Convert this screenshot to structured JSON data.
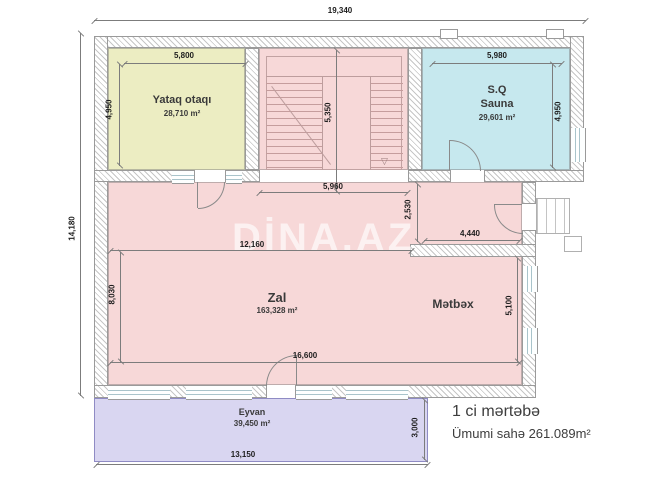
{
  "watermark": "DİNA.AZ",
  "footer": {
    "floor": "1 ci mərtəbə",
    "total_area": "Ümumi sahə 261.089m²"
  },
  "rooms": {
    "yataq": {
      "name": "Yataq otaqı",
      "area": "28,710 m²"
    },
    "sauna": {
      "label": "S.Q",
      "name": "Sauna",
      "area": "29,601 m²"
    },
    "zal": {
      "name": "Zal",
      "area": "163,328 m²"
    },
    "metbex": {
      "name": "Mətbəx"
    },
    "eyvan": {
      "name": "Eyvan",
      "area": "39,450 m²"
    }
  },
  "dims": {
    "total_w": "19,340",
    "total_h": "14,180",
    "yataq_w": "5,800",
    "yataq_h": "4,950",
    "sauna_w": "5,980",
    "sauna_h": "4,950",
    "stair_h": "5,350",
    "stair_w": "5,960",
    "hall_h": "2,530",
    "hall_w": "4,440",
    "zal_w_upper": "12,160",
    "zal_h_left": "8,030",
    "zal_w_lower": "16,600",
    "metbex_h": "5,100",
    "eyvan_h": "3,000",
    "eyvan_w": "13,150"
  },
  "icons": {
    "stairs_arrow": "▽"
  },
  "colors": {
    "bedroom_fill": "#ecedc2",
    "sauna_fill": "#c6e8ee",
    "hall_fill": "#f7d8d8",
    "balcony_fill": "#d9d6f1",
    "wall_hatch": "#c6c6c6",
    "dim_text": "#1d1d1d"
  }
}
